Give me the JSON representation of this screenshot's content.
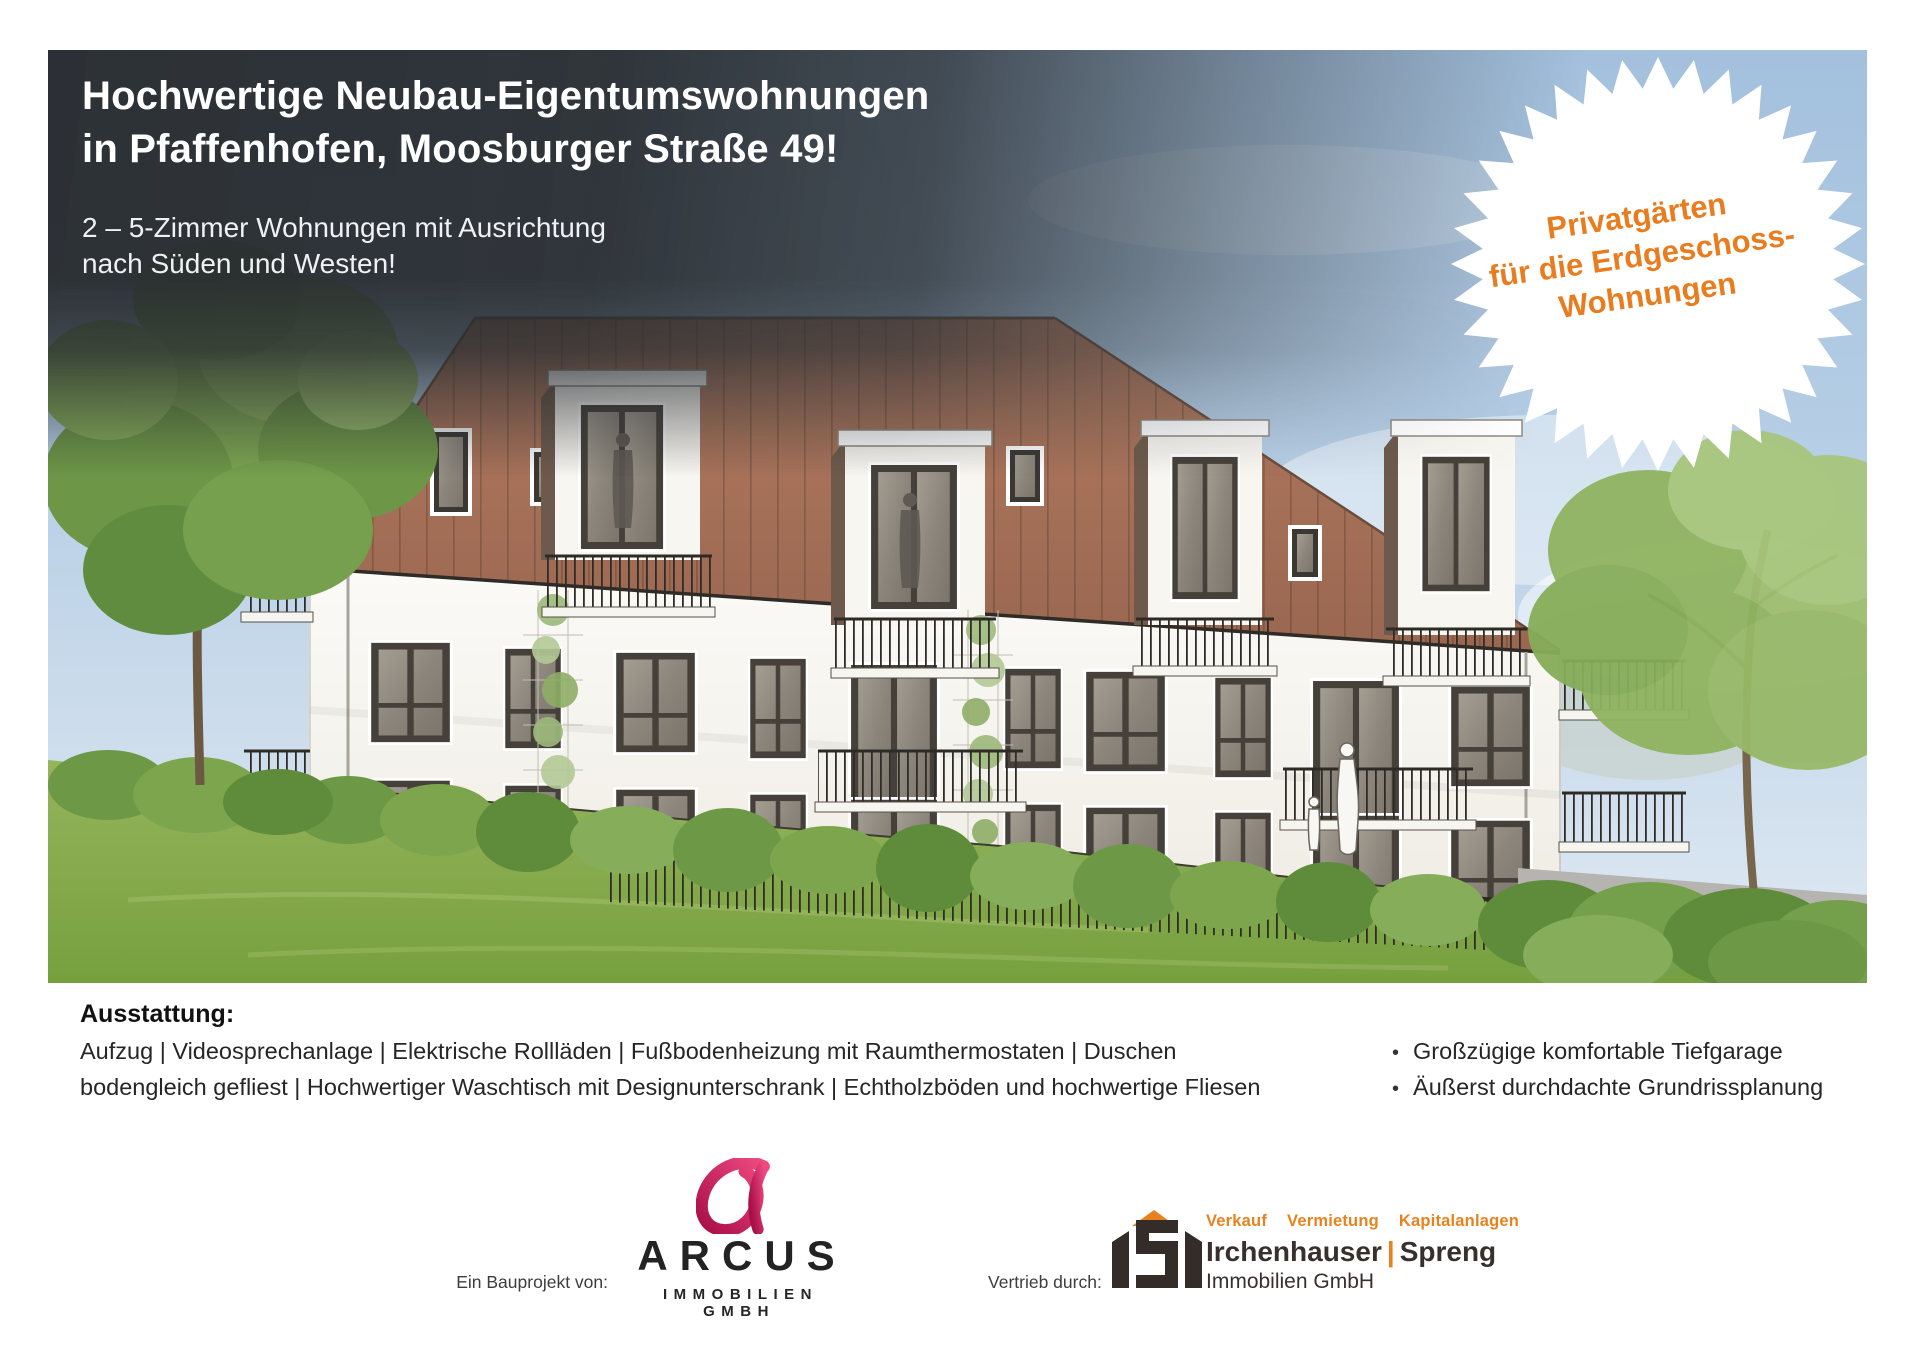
{
  "hero": {
    "title_line1": "Hochwertige Neubau-Eigentumswohnungen",
    "title_line2": "in Pfaffenhofen, Moosburger Straße 49!",
    "subtitle_line1": "2 – 5-Zimmer Wohnungen mit Ausrichtung",
    "subtitle_line2": "nach Süden und Westen!",
    "badge": {
      "line1": "Privatgärten",
      "line2": "für die Erdgeschoss-",
      "line3": "Wohnungen",
      "text_color": "#e87c1e",
      "background": "#ffffff"
    }
  },
  "scene": {
    "sky_color": "#b4cde5",
    "roof_color": "#a8715a",
    "facade_color": "#f7f5ef",
    "lawn_color": "#84a94c"
  },
  "features": {
    "heading": "Ausstattung:",
    "bullet_glyph": "•",
    "left_lines": [
      "Aufzug | Videosprechanlage | Elektrische Rollläden | Fußbodenheizung mit Raumthermostaten | Duschen",
      "bodengleich gefliest | Hochwertiger Waschtisch mit Designunterschrank | Echtholzböden und hochwertige Fliesen"
    ],
    "right_bullets": [
      "Großzügige komfortable Tiefgarage",
      "Äußerst durchdachte Grundrissplanung"
    ]
  },
  "footer": {
    "developer": {
      "label": "Ein Bauprojekt von:",
      "wordmark": "ARCUS",
      "subline": "IMMOBILIEN GMBH",
      "brand_color": "#d81b5d"
    },
    "distributor": {
      "label": "Vertrieb durch:",
      "services": [
        "Verkauf",
        "Vermietung",
        "Kapitalanlagen"
      ],
      "name_left": "Irchenhauser",
      "divider": "|",
      "name_right": "Spreng",
      "subline": "Immobilien GmbH",
      "accent_color": "#e8821e"
    }
  }
}
